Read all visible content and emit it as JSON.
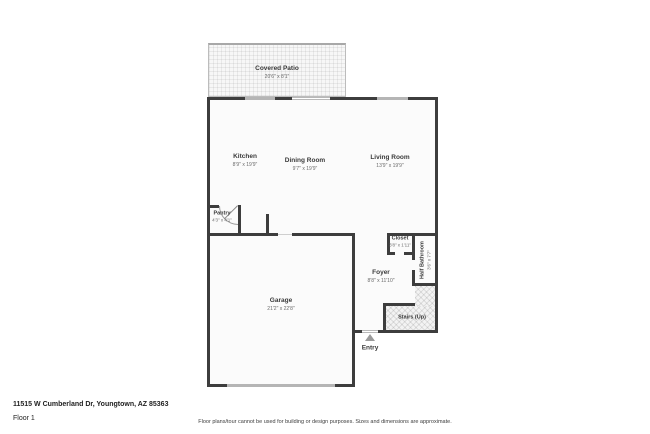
{
  "page": {
    "address": "11515 W Cumberland Dr, Youngtown, AZ 85363",
    "floor_label": "Floor 1",
    "disclaimer": "Floor plans/tour cannot be used for building or design purposes. Sizes and dimensions are approximate."
  },
  "rooms": {
    "covered_patio": {
      "name": "Covered Patio",
      "dims": "20'6\" x 8'1\""
    },
    "kitchen": {
      "name": "Kitchen",
      "dims": "8'9\" x 19'9\""
    },
    "dining_room": {
      "name": "Dining Room",
      "dims": "9'7\" x 19'9\""
    },
    "living_room": {
      "name": "Living Room",
      "dims": "13'9\" x 19'9\""
    },
    "pantry": {
      "name": "Pantry",
      "dims": "4'3\" x 4'1\""
    },
    "closet": {
      "name": "Closet",
      "dims": "3'8\" x 1'11\""
    },
    "half_bathroom": {
      "name": "Half Bathroom",
      "dims": "3'6\" x 7'7\""
    },
    "foyer": {
      "name": "Foyer",
      "dims": "8'8\" x 11'10\""
    },
    "garage": {
      "name": "Garage",
      "dims": "21'2\" x 22'8\""
    },
    "stairs": {
      "name": "Stairs (Up)"
    },
    "entry": {
      "name": "Entry"
    }
  },
  "colors": {
    "wall": "#3d3d3d",
    "window": "#b5b5b5",
    "floor": "#fbfbfb"
  }
}
